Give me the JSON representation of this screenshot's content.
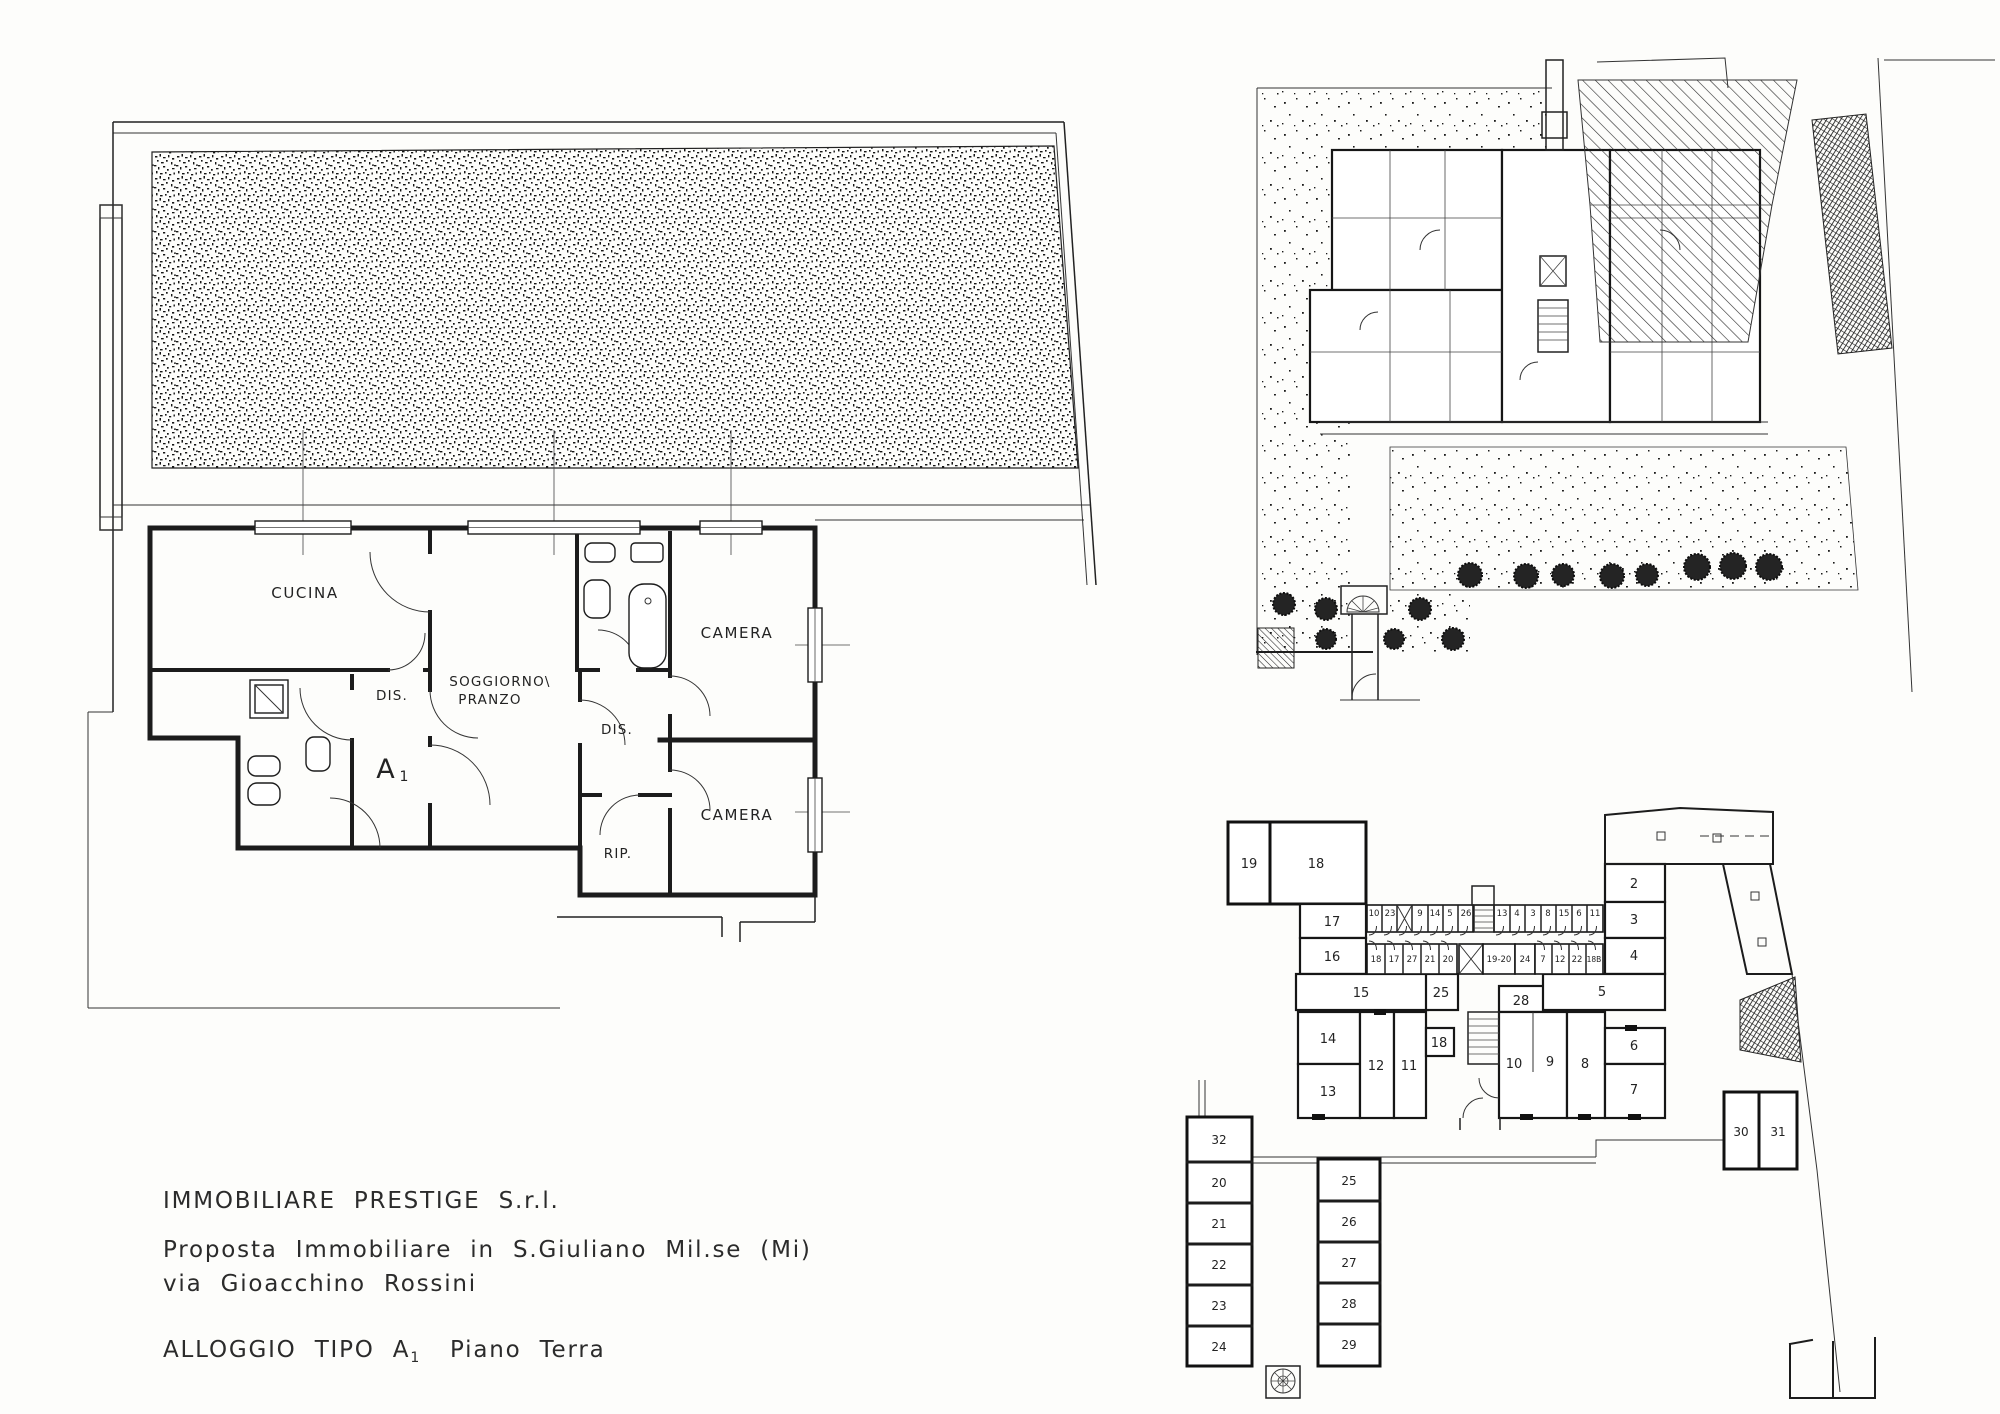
{
  "title_block": {
    "company": "IMMOBILIARE PRESTIGE S.r.l.",
    "proposal": "Proposta Immobiliare in S.Giuliano Mil.se (Mi)",
    "address": "via Gioacchino Rossini",
    "unit": "ALLOGGIO TIPO A",
    "unit_sub": "1",
    "floor": "Piano Terra"
  },
  "apartment_plan": {
    "kitchen": "CUCINA",
    "living1": "SOGGIORNO\\",
    "living2": "PRANZO",
    "dis1": "DIS.",
    "dis2": "DIS.",
    "rip": "RIP.",
    "camera1": "CAMERA",
    "camera2": "CAMERA",
    "unit": "A",
    "unit_sub": "1"
  },
  "basement_plan": {
    "rooms_top_left": [
      "19",
      "18",
      "17",
      "16"
    ],
    "rooms_mid_left": [
      "15",
      "14",
      "13",
      "12",
      "11"
    ],
    "rooms_center": [
      "25",
      "18",
      "28",
      "10",
      "9",
      "8"
    ],
    "rooms_right": [
      "2",
      "3",
      "4",
      "5",
      "6",
      "7"
    ],
    "cantina_row1": [
      "10",
      "23",
      "9",
      "14",
      "5",
      "26",
      "13",
      "4",
      "3",
      "8",
      "15",
      "6",
      "11"
    ],
    "cantina_row2": [
      "18",
      "17",
      "27",
      "21",
      "20",
      "19-20",
      "24",
      "7",
      "12",
      "22",
      "18B"
    ],
    "garage_col_left": [
      "32",
      "20",
      "21",
      "22",
      "23",
      "24"
    ],
    "garage_col_mid": [
      "25",
      "26",
      "27",
      "28",
      "29"
    ],
    "garage_pair": [
      "30",
      "31"
    ]
  }
}
